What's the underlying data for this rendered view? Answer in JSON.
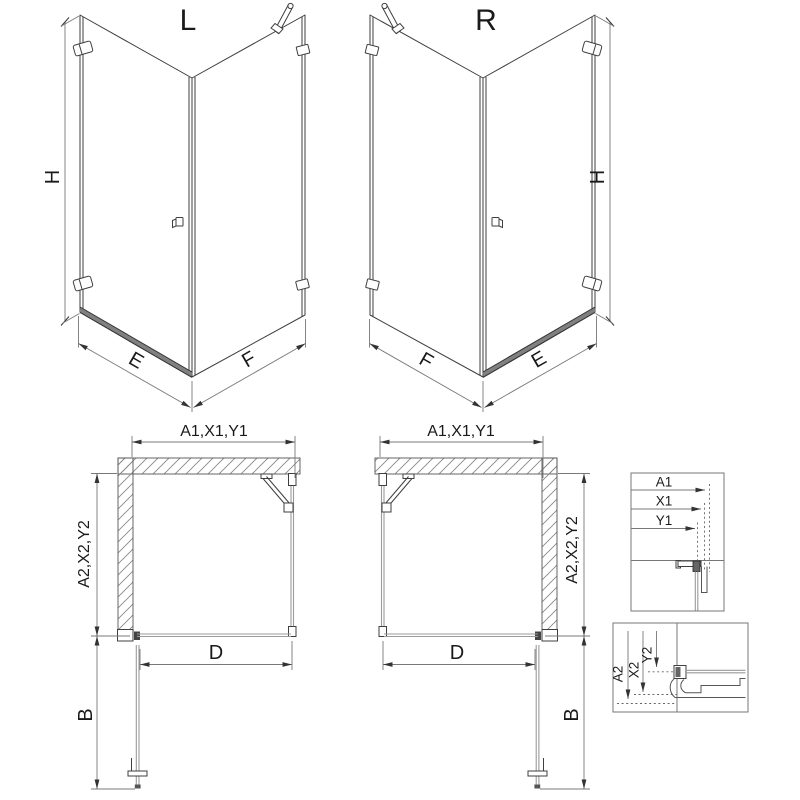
{
  "colors": {
    "line": "#3f3f3f",
    "dim": "#787878",
    "text": "#1a1a1a",
    "glass": "#9a9a9a",
    "background": "#ffffff"
  },
  "iso_left": {
    "variant_label": "L",
    "height": "H",
    "door_side": "E",
    "fixed_side": "F"
  },
  "iso_right": {
    "variant_label": "R",
    "height": "H",
    "door_side": "E",
    "fixed_side": "F"
  },
  "plan_left": {
    "width": "A1,X1,Y1",
    "depth": "A2,X2,Y2",
    "door_width": "D",
    "door_swing": "B"
  },
  "plan_right": {
    "width": "A1,X1,Y1",
    "depth": "A2,X2,Y2",
    "door_width": "D",
    "door_swing": "B"
  },
  "detail_width": {
    "labels": [
      "A1",
      "X1",
      "Y1"
    ]
  },
  "detail_depth": {
    "labels": [
      "A2",
      "X2",
      "Y2"
    ]
  }
}
